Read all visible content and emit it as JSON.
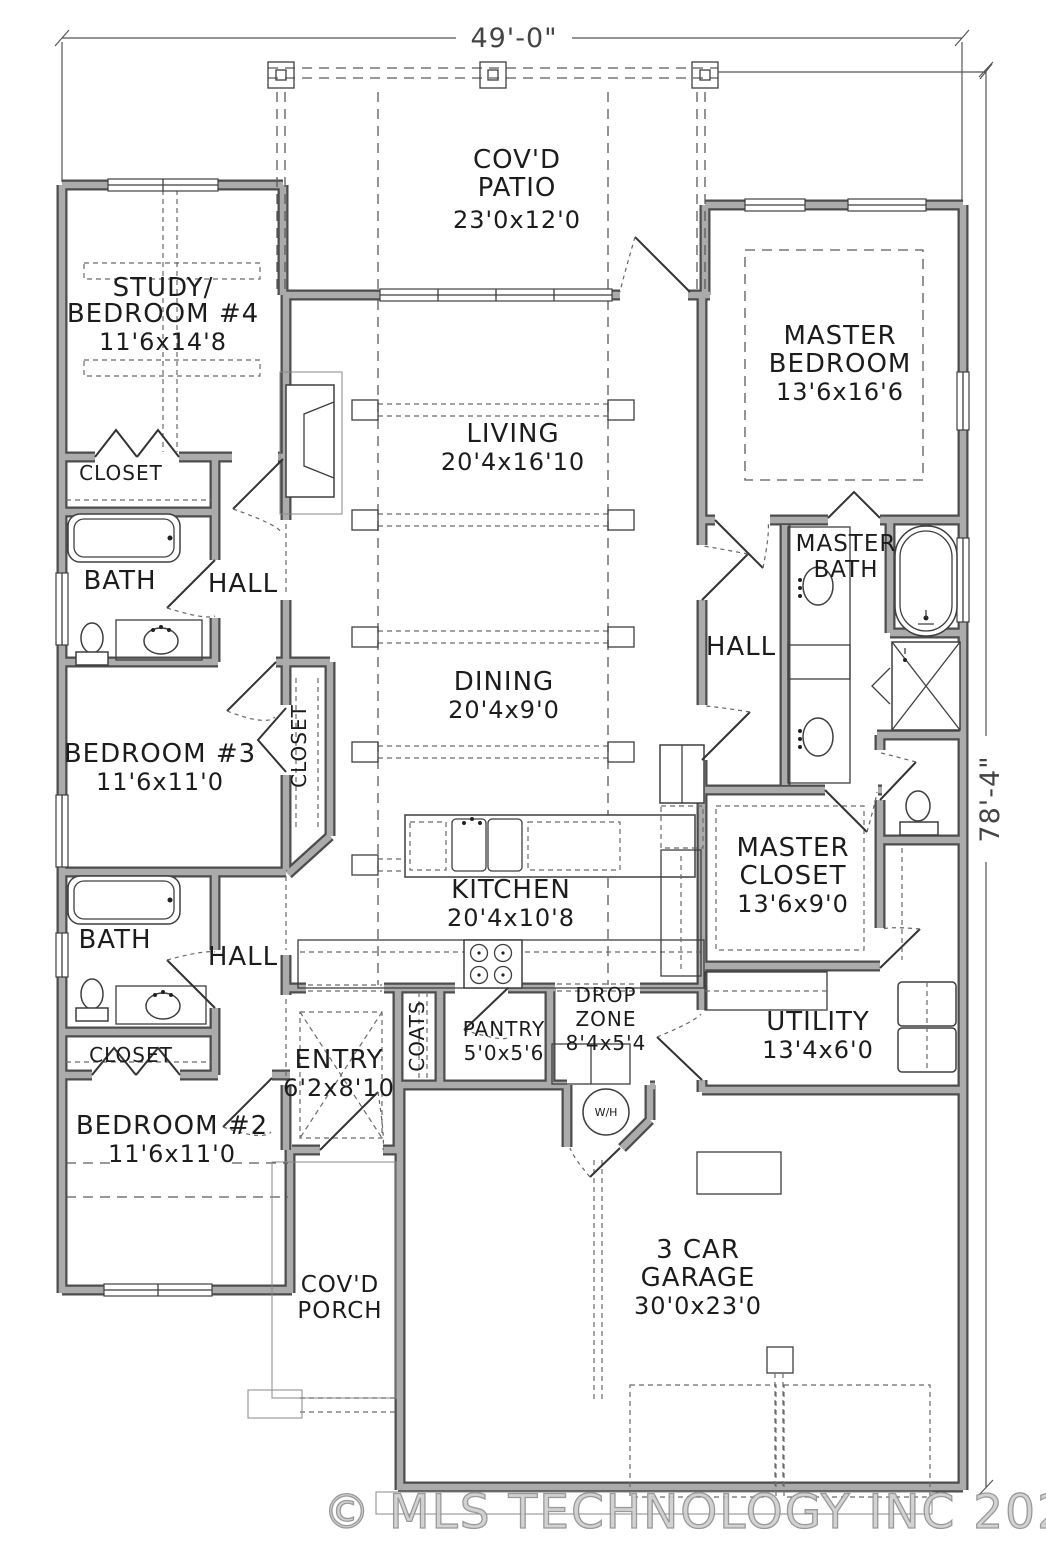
{
  "colors": {
    "wall_core": "#ababab",
    "wall_edge": "#4d4d4d",
    "line": "#3f3f3f",
    "dash": "#5a5a5a",
    "text": "#1c1c1c",
    "watermark": "#cecece"
  },
  "dimensions": {
    "width": "49'-0\"",
    "height": "78'-4\""
  },
  "watermark": "© MLS TECHNOLOGY INC 2026",
  "rooms": {
    "patio": {
      "l1": "COV'D",
      "l2": "PATIO",
      "size": "23'0x12'0"
    },
    "study": {
      "l1": "STUDY/",
      "l2": "BEDROOM #4",
      "size": "11'6x14'8"
    },
    "master_bedroom": {
      "l1": "MASTER",
      "l2": "BEDROOM",
      "size": "13'6x16'6"
    },
    "living": {
      "l1": "LIVING",
      "size": "20'4x16'10"
    },
    "dining": {
      "l1": "DINING",
      "size": "20'4x9'0"
    },
    "kitchen": {
      "l1": "KITCHEN",
      "size": "20'4x10'8"
    },
    "master_bath": {
      "l1": "MASTER",
      "l2": "BATH"
    },
    "hall_master": {
      "l1": "HALL"
    },
    "master_closet": {
      "l1": "MASTER",
      "l2": "CLOSET",
      "size": "13'6x9'0"
    },
    "utility": {
      "l1": "UTILITY",
      "size": "13'4x6'0"
    },
    "drop_zone": {
      "l1": "DROP",
      "l2": "ZONE",
      "size": "8'4x5'4"
    },
    "pantry": {
      "l1": "PANTRY",
      "size": "5'0x5'6"
    },
    "coats": {
      "l1": "COATS"
    },
    "entry": {
      "l1": "ENTRY",
      "size": "6'2x8'10"
    },
    "bedroom3": {
      "l1": "BEDROOM #3",
      "size": "11'6x11'0"
    },
    "bedroom2": {
      "l1": "BEDROOM #2",
      "size": "11'6x11'0"
    },
    "bath_upper": {
      "l1": "BATH"
    },
    "hall_upper": {
      "l1": "HALL"
    },
    "closet_upper": {
      "l1": "CLOSET"
    },
    "closet_br3": {
      "l1": "CLOSET"
    },
    "bath_lower": {
      "l1": "BATH"
    },
    "hall_lower": {
      "l1": "HALL"
    },
    "closet_lower": {
      "l1": "CLOSET"
    },
    "garage": {
      "l1": "3 CAR",
      "l2": "GARAGE",
      "size": "30'0x23'0"
    },
    "porch": {
      "l1": "COV'D",
      "l2": "PORCH"
    },
    "water_heater": {
      "label": "W/H"
    }
  }
}
